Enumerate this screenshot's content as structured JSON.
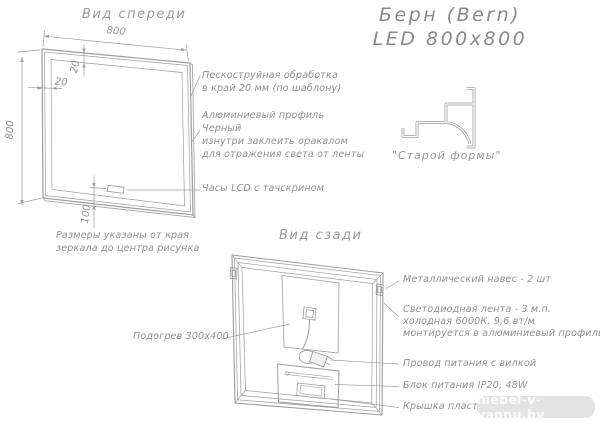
{
  "page": {
    "title_line1": "Берн (Bern)",
    "title_line2": "LED 800x800",
    "watermark": "mebel-v-vannu.by"
  },
  "front_view": {
    "label": "Вид спереди",
    "dim_width": "800",
    "dim_height": "800",
    "dim_border_top": "20",
    "dim_border_left": "20",
    "dim_clock_offset": "100",
    "ann_sandblast_line1": "Пескоструйная обработка",
    "ann_sandblast_line2": "в край 20 мм (по шаблону)",
    "ann_profile_line1": "Алюминиевый профиль",
    "ann_profile_line2": "Черный",
    "ann_profile_line3": "изнутри заклеить оракалом",
    "ann_profile_line4": "для отражения света от ленты",
    "ann_clock": "Часы LCD с тачскрином",
    "note_line1": "Размеры указаны от края",
    "note_line2": "зеркала до центра рисунка"
  },
  "profile_section": {
    "caption": "\"Старой формы\""
  },
  "rear_view": {
    "label": "Вид сзади",
    "ann_heating": "Подогрев 300x400",
    "ann_hanger": "Металлический навес - 2 шт",
    "ann_led_line1": "Светодиодная лента - 3 м.п.",
    "ann_led_line2": "холодная 6000К, 9,6 вт/м",
    "ann_led_line3": "монтируется в алюминиевый профиль",
    "ann_cord": "Провод питания с вилкой",
    "ann_psu": "Блок питания IP20, 48W",
    "ann_cover": "Крышка пластмассовая"
  },
  "colors": {
    "drawing_line": "#9c9c9c",
    "text": "#8f8f8f",
    "watermark_bg": "#e3e3e3",
    "watermark_text": "#fbfbfb"
  }
}
